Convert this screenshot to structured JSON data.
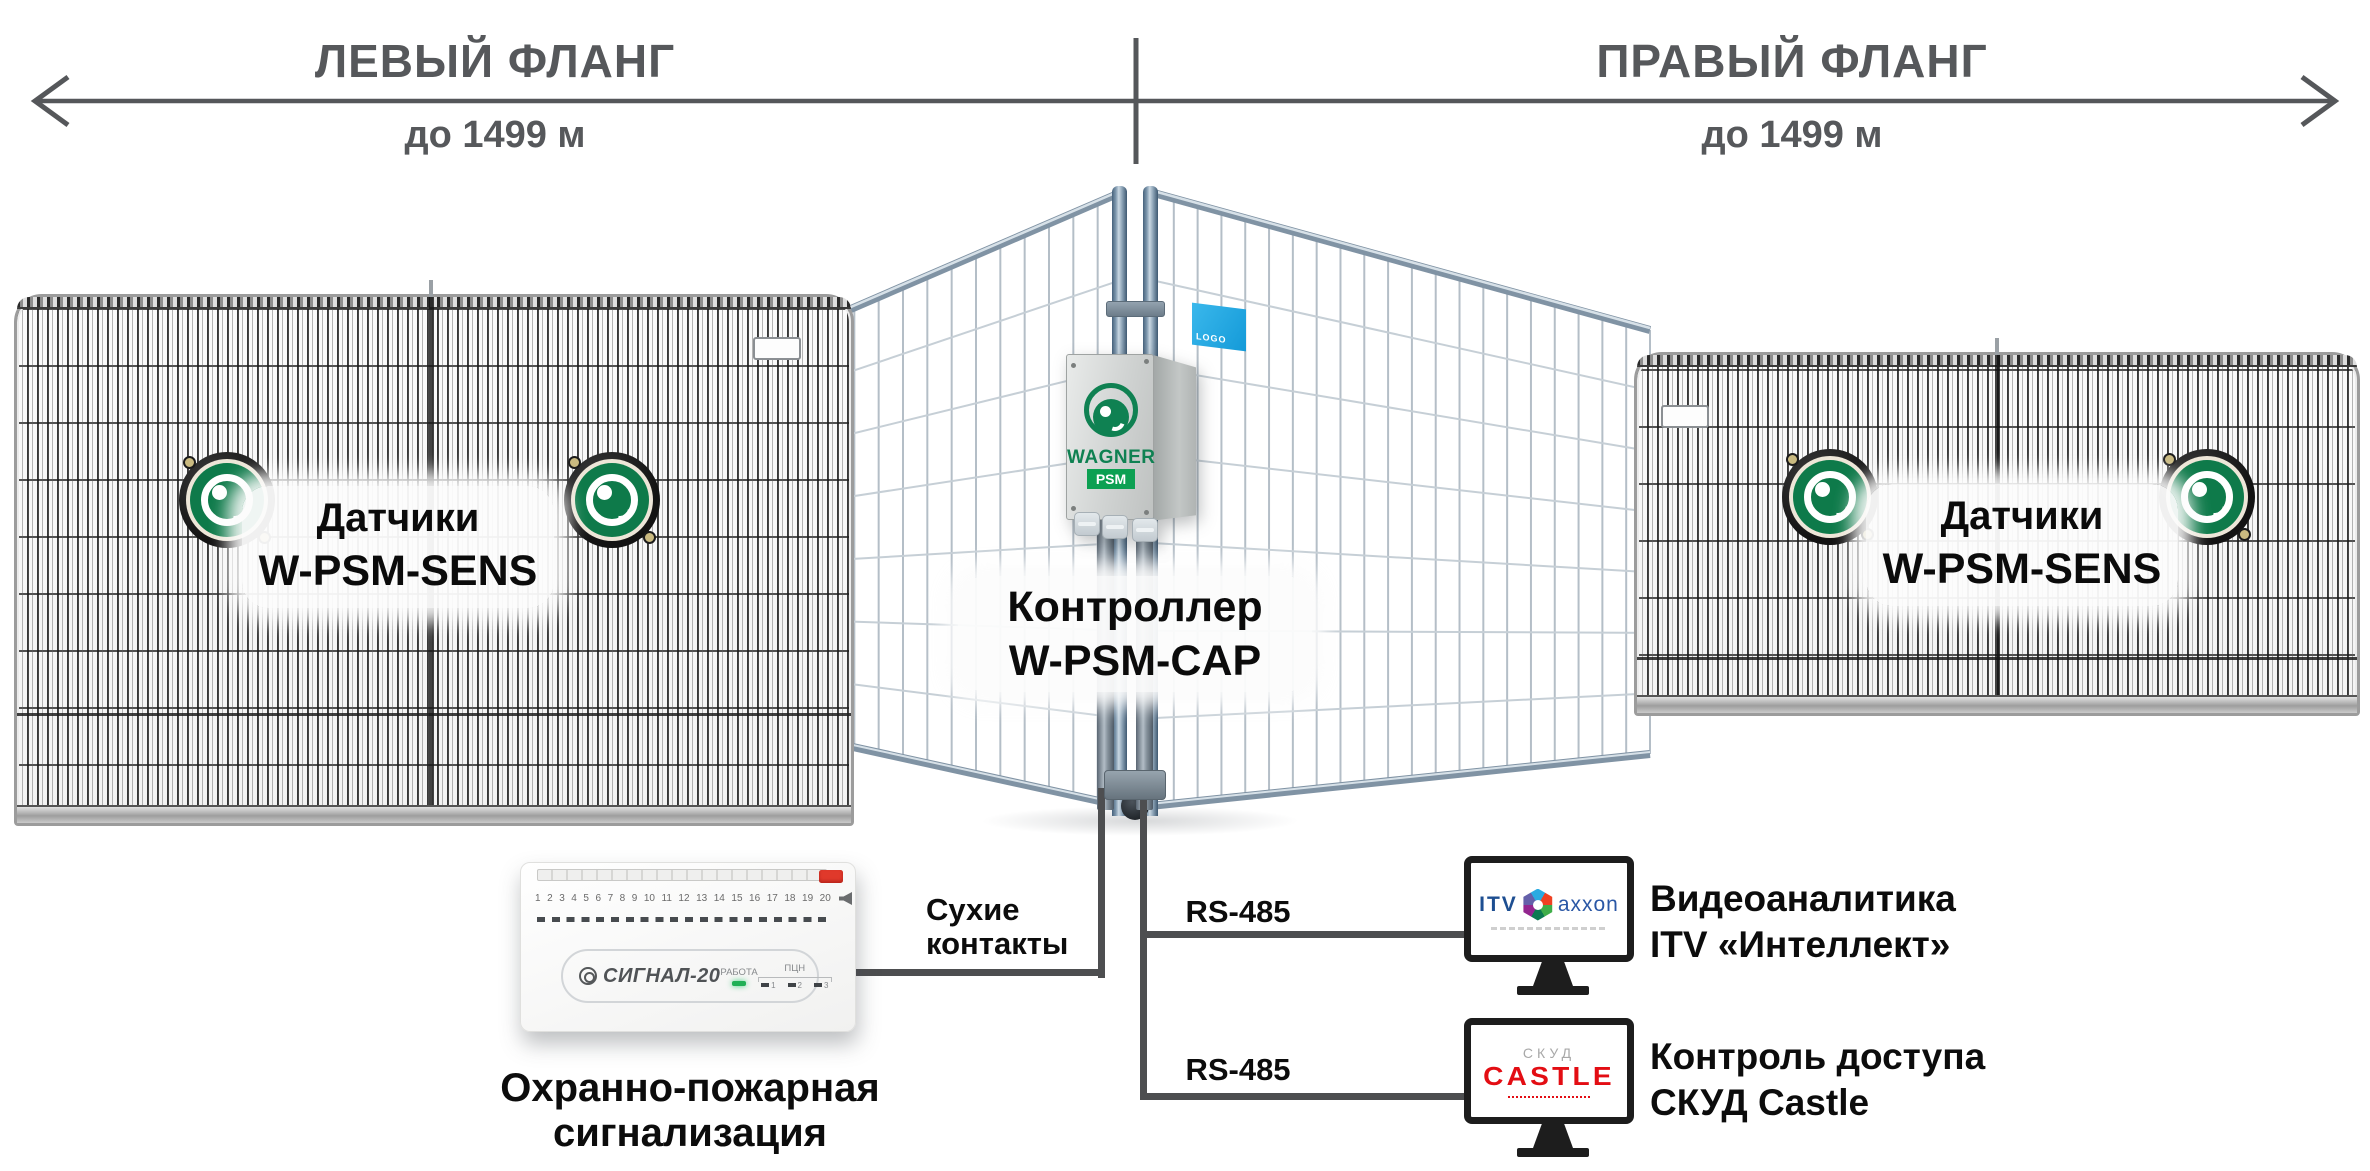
{
  "header": {
    "left_flank": {
      "title": "ЛЕВЫЙ ФЛАНГ",
      "distance": "до 1499 м"
    },
    "right_flank": {
      "title": "ПРАВЫЙ ФЛАНГ",
      "distance": "до 1499 м"
    }
  },
  "colors": {
    "header_gray": "#56585b",
    "line_gray": "#4d4e50",
    "wagner_green": "#0f8152",
    "castle_red": "#e30d13",
    "itv_blue": "#1d4e91",
    "sticker_blue": "#29abe2"
  },
  "left_fence": {
    "label_line1": "Датчики",
    "label_line2": "W-PSM-SENS"
  },
  "right_fence": {
    "label_line1": "Датчики",
    "label_line2": "W-PSM-SENS"
  },
  "controller": {
    "label_line1": "Контроллер",
    "label_line2": "W-PSM-CAP",
    "brand": "WAGNER",
    "brand_sub": "PSM",
    "sticker_text": "LOGO"
  },
  "connections": {
    "dry_contacts_line1": "Сухие",
    "dry_contacts_line2": "контакты",
    "rs485_top": "RS-485",
    "rs485_bottom": "RS-485"
  },
  "signal20": {
    "terminal_numbers": [
      "1",
      "2",
      "3",
      "4",
      "5",
      "6",
      "7",
      "8",
      "9",
      "10",
      "11",
      "12",
      "13",
      "14",
      "15",
      "16",
      "17",
      "18",
      "19",
      "20"
    ],
    "logo": "СИГНАЛ-20",
    "work_label": "РАБОТА",
    "pcn_label": "ПЦН",
    "pcn_leds": [
      "1",
      "2",
      "3"
    ],
    "caption_line1": "Охранно-пожарная",
    "caption_line2": "сигнализация"
  },
  "video_analytics": {
    "logo_itv": "ITV",
    "logo_axxon": "axxon",
    "caption_line1": "Видеоаналитика",
    "caption_line2": "ITV «Интеллект»"
  },
  "access_control": {
    "logo_top": "СКУД",
    "logo_main": "CASTLE",
    "caption_line1": "Контроль доступа",
    "caption_line2": "СКУД Castle"
  }
}
